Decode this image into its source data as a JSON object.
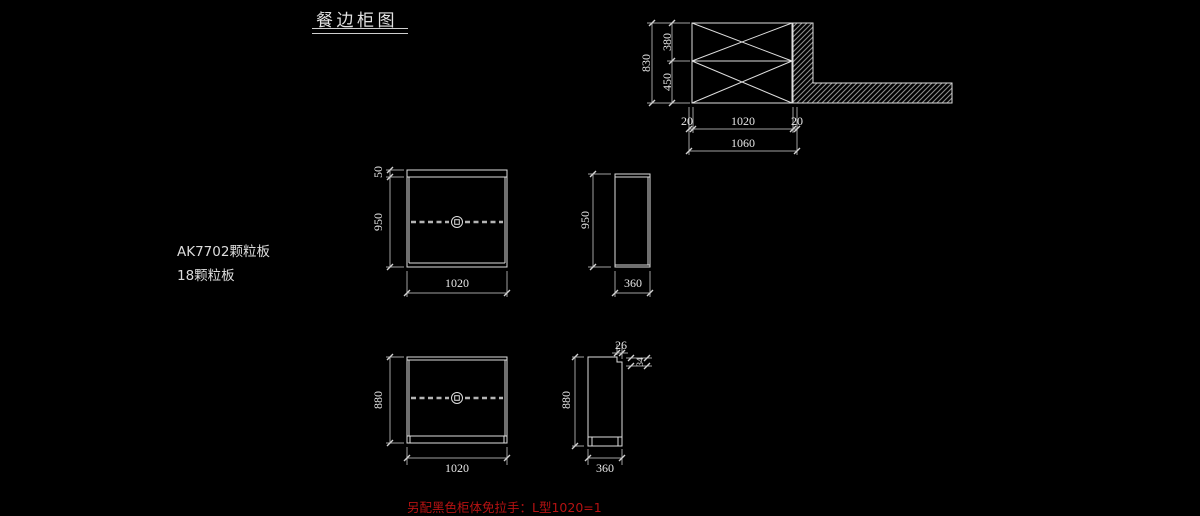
{
  "title": {
    "text": "餐边柜图"
  },
  "notes": {
    "material_1": "AK7702颗粒板",
    "material_2": "18颗粒板",
    "handle": "另配黑色柜体免拉手：L型1020=1"
  },
  "top_view": {
    "dim_830": "830",
    "dim_380": "380",
    "dim_450": "450",
    "dim_20_left": "20",
    "dim_1020": "1020",
    "dim_20_right": "20",
    "dim_1060": "1060"
  },
  "front_upper": {
    "dim_50": "50",
    "dim_950": "950",
    "dim_1020": "1020"
  },
  "side_upper": {
    "dim_950": "950",
    "dim_360": "360"
  },
  "front_lower": {
    "dim_880": "880",
    "dim_1020": "1020"
  },
  "side_lower": {
    "dim_880": "880",
    "dim_360": "360",
    "dim_26": "26",
    "dim_34": "34"
  },
  "colors": {
    "background": "#000000",
    "object_line": "#dedede",
    "dim_line": "#a0a0a0",
    "dim_text": "#e8e8e8",
    "hatch": "#8d8d8d",
    "note_text": "#dcdcdc",
    "note_red": "#b51212"
  }
}
